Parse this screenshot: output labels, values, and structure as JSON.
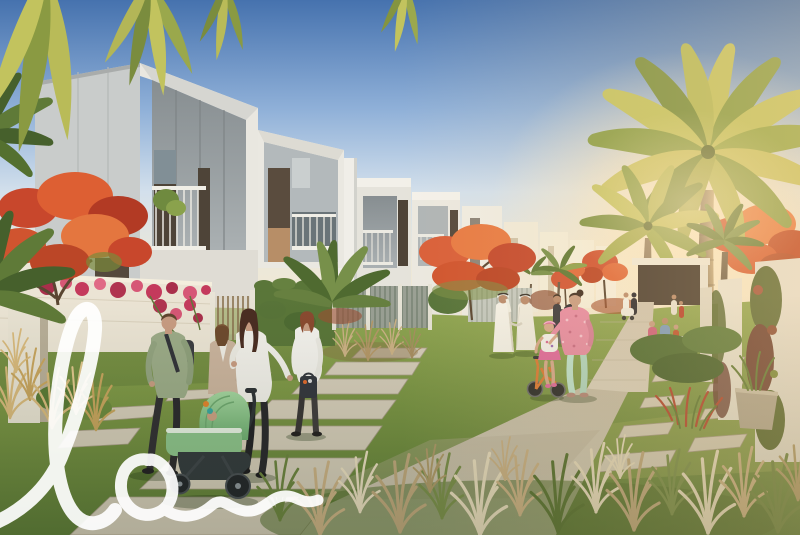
{
  "image": {
    "kind": "architectural rendering",
    "description": "Sunlit rendering of a modern villa community: rows of white townhouses with recessed balconies, date palms and red flame trees, garden walls draped in bougainvillea, families strolling on a landscaped paver path, a mother pushing a green pram, Emirati men in white kanduras chatting, and a girl in a pink helmet on an orange balance bike."
  },
  "watermark": {
    "text": "lo",
    "color": "#ffffff"
  },
  "palette": {
    "sky_top": "#4672ae",
    "sky_mid": "#8fb0d8",
    "sky_pale": "#d3e0ec",
    "sky_horizon": "#f2e8d2",
    "sun_glow": "#ffeccb",
    "building_white": "#edebe4",
    "building_shade": "#c6c9c8",
    "opening_shade": "#99a0a3",
    "window_dark": "#4e4438",
    "dark_wall": "#4a3e33",
    "lawn_light": "#93a854",
    "lawn": "#7b9545",
    "lawn_shadow": "#5e7c38",
    "paver_light": "#dcd4c2",
    "paver": "#c9c0ac",
    "paver_shadow": "#a99e88",
    "trunk": "#9b8668",
    "palm_light": "#c4c465",
    "palm_mid": "#8da04c",
    "palm_dark": "#5f7836",
    "flame_red": "#d0502f",
    "flame_orange": "#e87c46",
    "bougainvillea": "#c43a5c",
    "hedge": "#5a7639",
    "grass_plume": "#ecdfc2",
    "grass_wheat": "#cdb286",
    "stroller_green": "#8ec48c",
    "bike_orange": "#dd7a35",
    "kandura_white": "#f5f2e9",
    "mint_pants": "#bfe3cf",
    "pink_top": "#e88ca4"
  },
  "scene": {
    "buildings": [
      "foreground villa with recessed balcony",
      "second villa with lit tall window",
      "row of mid townhouses with balconies",
      "distant receding white houses",
      "dark stone pavilion wall",
      "vine-covered white fin walls"
    ],
    "vegetation": [
      "overhanging palm fronds",
      "large backlit date palm",
      "medium and small date palms",
      "red royal poinciana trees",
      "bougainvillea on garden wall",
      "green hedges",
      "ornamental fountain grasses"
    ],
    "people": [
      "man in sage shirt walking",
      "woman in beige blazer",
      "woman in white cardigan pushing green pram",
      "baby in pram",
      "auburn-haired woman with handbag",
      "two Emirati men in white kanduras",
      "woman with black stroller",
      "mother in pink floral top and mint pants",
      "girl with pink helmet on balance bike",
      "distant couple with white scooter",
      "family seated on bench",
      "pair walking far right"
    ],
    "objects": [
      "green pram",
      "black stroller",
      "orange balance bike",
      "white bench",
      "garden gate with bars",
      "concrete paver path",
      "stepping stone pads",
      "white scooter"
    ]
  }
}
